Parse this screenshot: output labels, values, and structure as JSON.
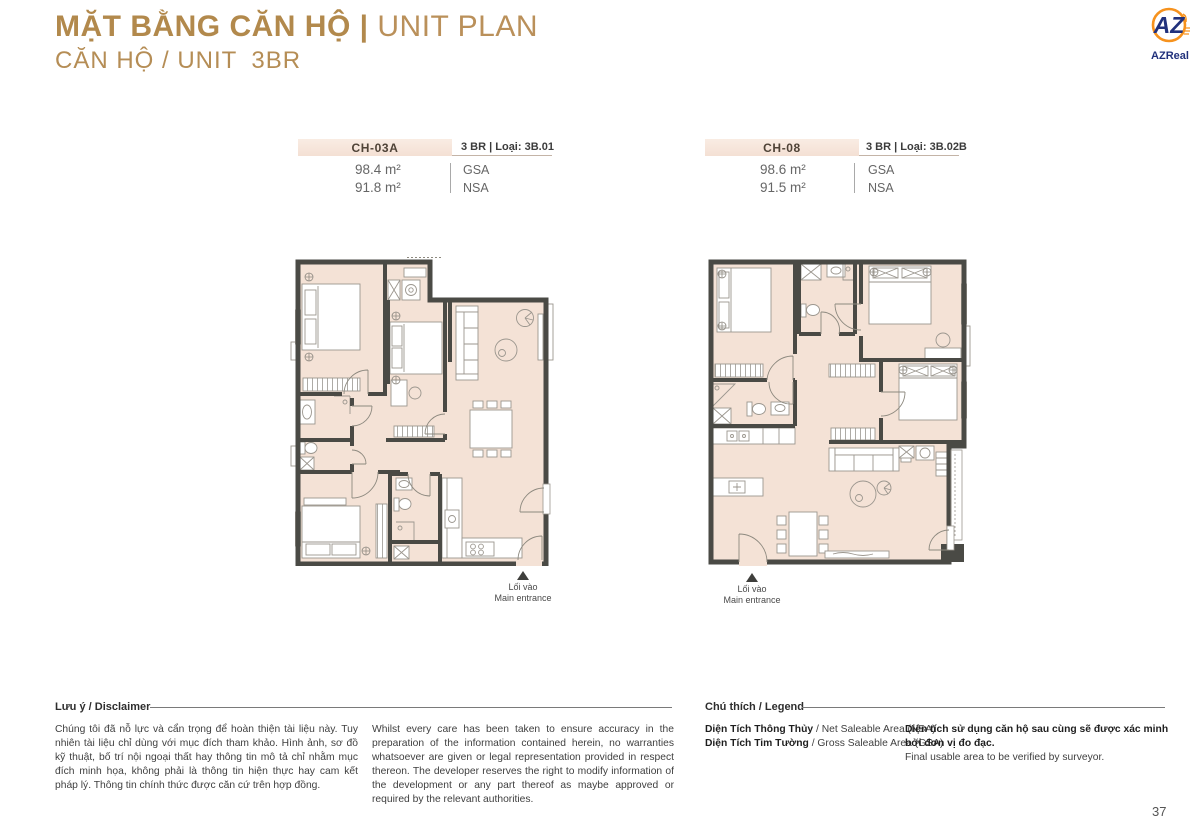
{
  "page": {
    "title_bold": "MẶT BẰNG CĂN HỘ |",
    "title_light": "UNIT PLAN",
    "subtitle_label": "CĂN HỘ / UNIT",
    "subtitle_value": "3BR",
    "number": "37"
  },
  "logo": {
    "monogram": "AZ",
    "name": "AZReal"
  },
  "units": [
    {
      "code": "CH-03A",
      "type": "3 BR | Loại: 3B.01",
      "gsa_value": "98.4 m²",
      "nsa_value": "91.8 m²",
      "gsa_label": "GSA",
      "nsa_label": "NSA",
      "entrance_vi": "Lối vào",
      "entrance_en": "Main entrance"
    },
    {
      "code": "CH-08",
      "type": "3 BR | Loại: 3B.02B",
      "gsa_value": "98.6 m²",
      "nsa_value": "91.5 m²",
      "gsa_label": "GSA",
      "nsa_label": "NSA",
      "entrance_vi": "Lối vào",
      "entrance_en": "Main entrance"
    }
  ],
  "disclaimer": {
    "heading": "Lưu ý / Disclaimer",
    "text_vi": "Chúng tôi đã nỗ lực và cẩn trọng để hoàn thiện tài liệu này. Tuy nhiên tài liệu chỉ dùng với mục đích tham khảo. Hình ảnh, sơ đồ kỹ thuật, bố trí nội ngoại thất hay thông tin mô tả chỉ nhằm mục đích minh họa, không phải là thông tin hiện thực hay cam kết pháp lý. Thông tin chính thức được căn cứ trên hợp đồng.",
    "text_en": "Whilst every care has been taken to ensure accuracy in the preparation of the information contained herein, no warranties whatsoever are given or legal representation provided in respect thereon. The developer reserves the right to modify information of the development or any part thereof as maybe approved or required by the relevant authorities."
  },
  "legend": {
    "heading": "Chú thích / Legend",
    "items": [
      {
        "bold": "Diện Tích Thông Thủy",
        "rest": " / Net Saleable Area (NSA)"
      },
      {
        "bold": "Diện Tích Tim Tường",
        "rest": " / Gross Saleable Area (GSA)"
      }
    ],
    "note_vi": "Diện tích sử dụng căn hộ sau cùng sẽ được xác minh bởi đơn vị đo đạc.",
    "note_en": "Final usable area to be verified by surveyor."
  },
  "colors": {
    "gold": "#b2894c",
    "bar_beige": "#f6e4d9",
    "floor_beige": "#f4e2d6",
    "wall": "#4a4a45",
    "logo_blue": "#21317c",
    "logo_orange": "#f6921e"
  }
}
